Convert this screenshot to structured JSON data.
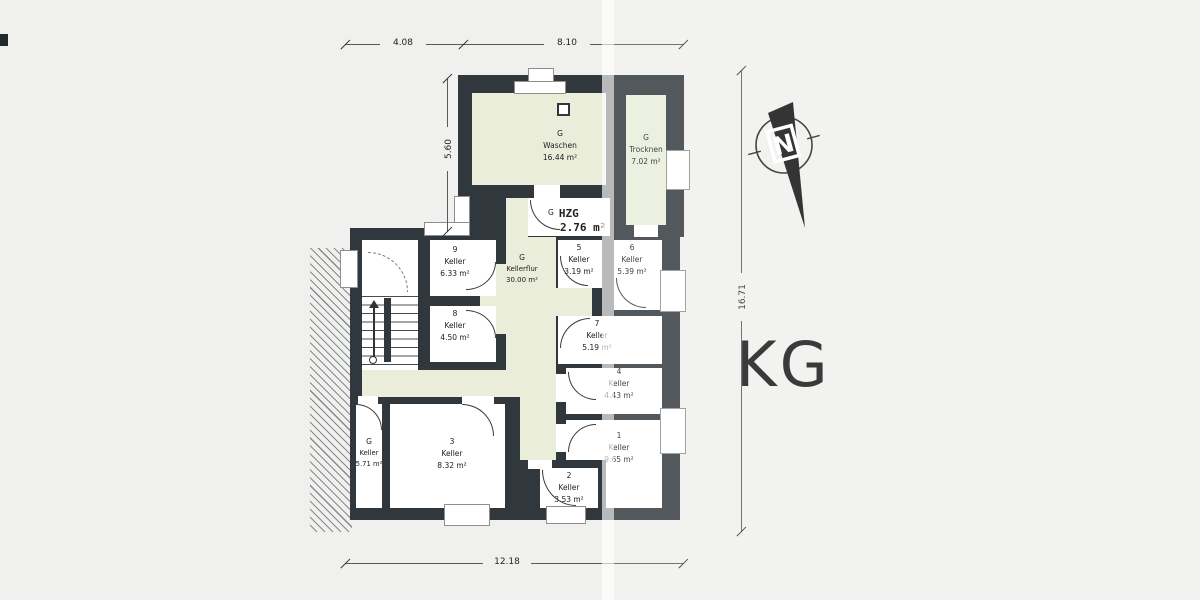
{
  "title": "KG",
  "north": "N",
  "colors": {
    "wall": "#31383d",
    "common_area": "#e9edda",
    "room": "#ffffff",
    "paper": "#f0f1ee"
  },
  "dims": {
    "top_left": "4.08",
    "top_right": "8.10",
    "left": "5.60",
    "right": "16.71",
    "bottom": "12.18"
  },
  "rooms": [
    {
      "num": "G",
      "name": "Waschen",
      "area": "16.44 m²"
    },
    {
      "num": "G",
      "name": "Trocknen",
      "area": "7.02 m²"
    },
    {
      "num": "G",
      "name": "HZG",
      "area": "2.76 m²"
    },
    {
      "num": "9",
      "name": "Keller",
      "area": "6.33 m²"
    },
    {
      "num": "8",
      "name": "Keller",
      "area": "4.50 m²"
    },
    {
      "num": "G",
      "name": "Kellerflur",
      "area": "30.00 m²"
    },
    {
      "num": "5",
      "name": "Keller",
      "area": "3.19 m²"
    },
    {
      "num": "6",
      "name": "Keller",
      "area": "5.39 m²"
    },
    {
      "num": "7",
      "name": "Keller",
      "area": "5.19 m²"
    },
    {
      "num": "4",
      "name": "Keller",
      "area": "4.43 m²"
    },
    {
      "num": "1",
      "name": "Keller",
      "area": "9.65 m²"
    },
    {
      "num": "2",
      "name": "Keller",
      "area": "3.53 m²"
    },
    {
      "num": "3",
      "name": "Keller",
      "area": "8.32 m²"
    },
    {
      "num": "G",
      "name": "Keller",
      "area": "5.71 m²"
    }
  ]
}
